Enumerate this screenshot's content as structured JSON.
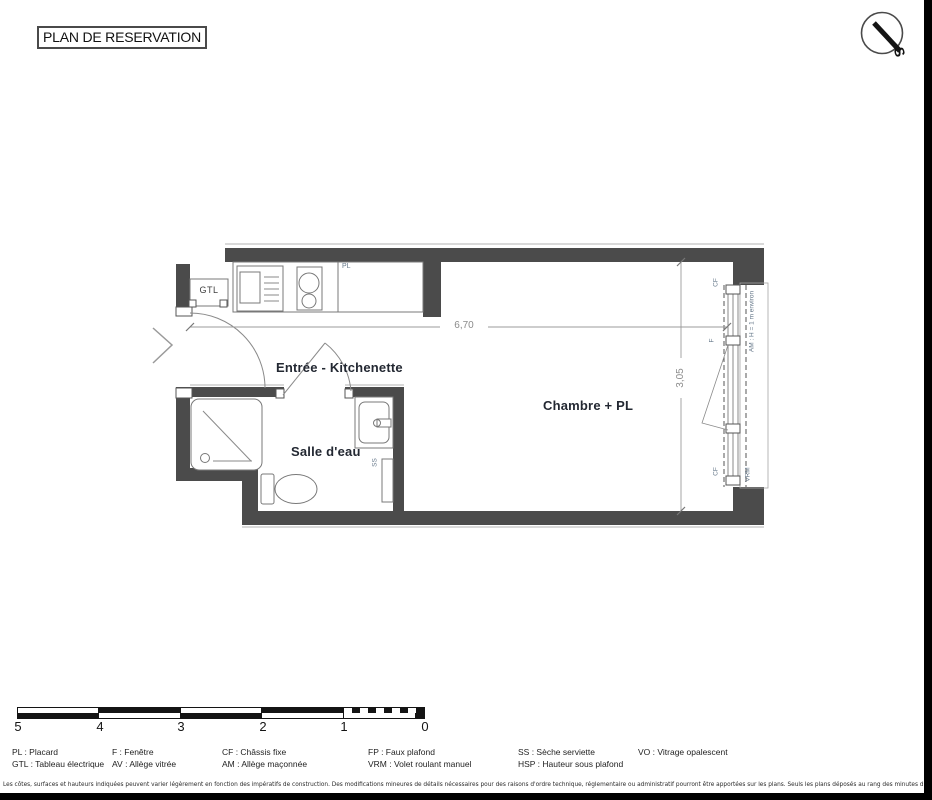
{
  "header": {
    "title": "PLAN DE RESERVATION"
  },
  "compass": {
    "south_label": "S"
  },
  "plan": {
    "room_labels": {
      "entree": "Entrée - Kitchenette",
      "salle_eau": "Salle d'eau",
      "chambre": "Chambre + PL"
    },
    "fixture_labels": {
      "gtl": "GTL",
      "pl": "PL",
      "ss": "SS"
    },
    "window_labels": {
      "cf_top": "CF",
      "f": "F",
      "cf_bottom": "CF",
      "vrm": "VRM",
      "am": "AM : H = 1 m environ"
    },
    "dimensions": {
      "width_m": "6,70",
      "depth_m": "3,05"
    }
  },
  "scale_bar": {
    "numbers": [
      "5",
      "4",
      "3",
      "2",
      "1",
      "0"
    ]
  },
  "legend": {
    "columns": [
      {
        "row1": "PL : Placard",
        "row2": "GTL : Tableau électrique"
      },
      {
        "row1": "F : Fenêtre",
        "row2": "AV : Allège vitrée"
      },
      {
        "row1": "CF : Châssis fixe",
        "row2": "AM : Allège maçonnée"
      },
      {
        "row1": "FP : Faux plafond",
        "row2": "VRM : Volet roulant manuel"
      },
      {
        "row1": "SS : Sèche serviette",
        "row2": "HSP : Hauteur sous plafond"
      },
      {
        "row1": "",
        "row2": "VO : Vitrage opalescent"
      }
    ]
  },
  "footnote": "Les côtes, surfaces et hauteurs indiquées peuvent varier légèrement en fonction des impératifs de construction. Des modifications mineures de détails nécessaires pour des raisons d'ordre technique, réglementaire ou administratif pourront être apportées sur les plans. Seuls les plans déposés au rang des minutes du notaire font foi.",
  "colors": {
    "wall": "#4b4b4b",
    "plan_line": "#8a8a8a",
    "room_label": "#232832",
    "dim_text": "#8b8b8b",
    "window_label_text": "#66788a",
    "scale_black": "#141414"
  }
}
